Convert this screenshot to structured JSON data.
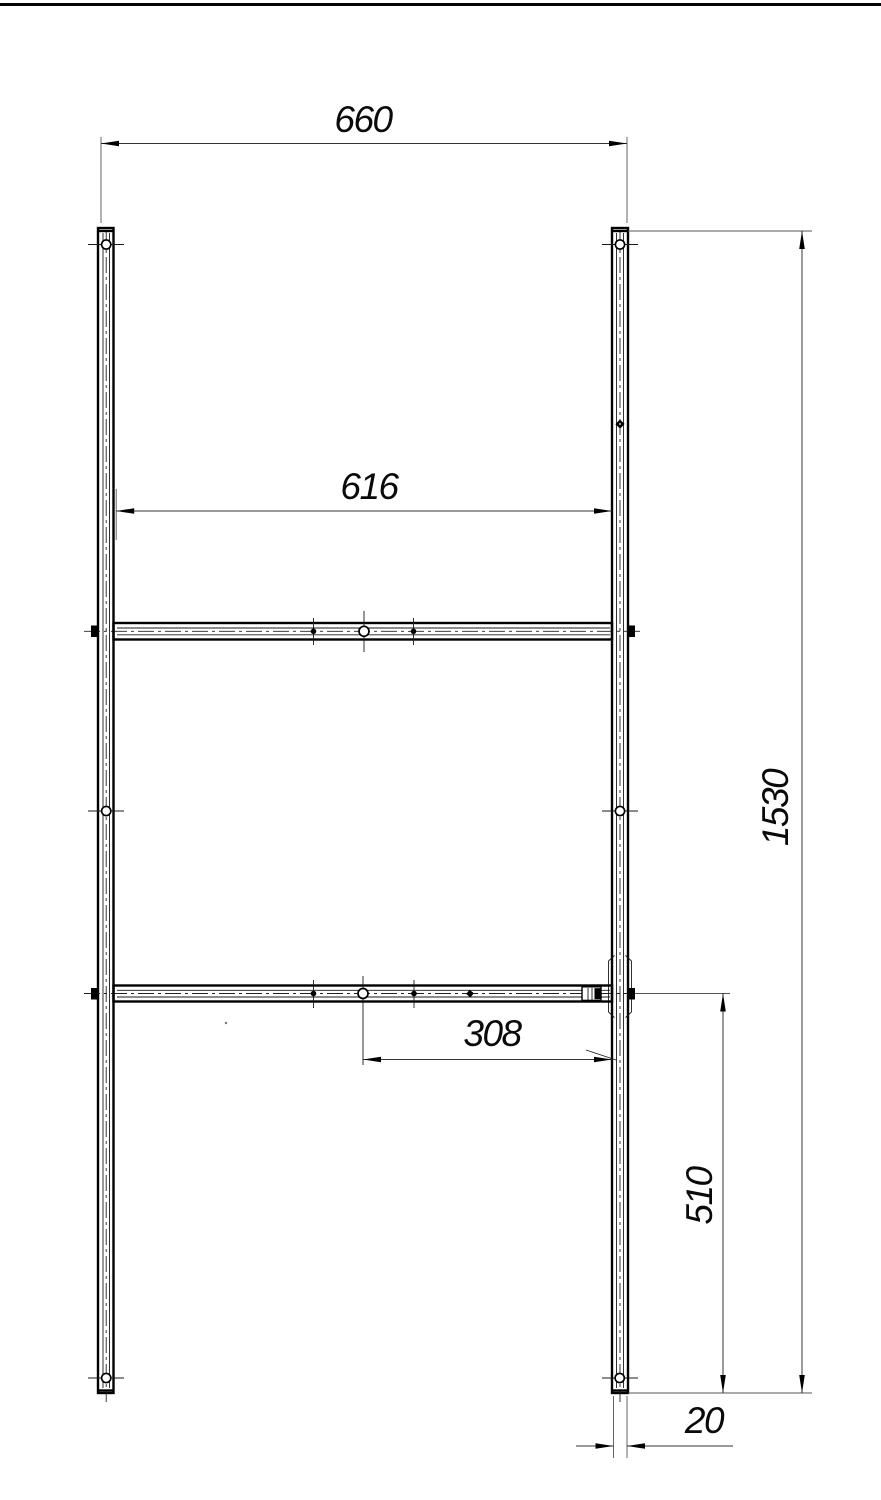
{
  "drawing": {
    "background": "#ffffff",
    "ink_color": "#0a0a0a",
    "dims": {
      "overall_width": "660",
      "rung_length": "616",
      "hole_to_post": "308",
      "overall_height": "1530",
      "lower_height": "510",
      "profile_width": "20"
    }
  }
}
